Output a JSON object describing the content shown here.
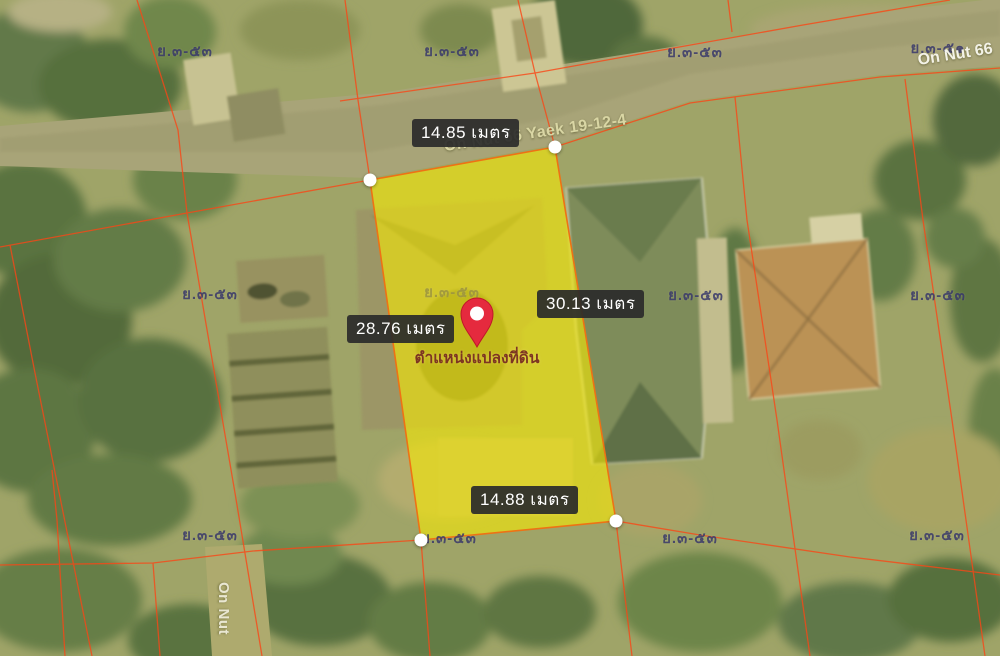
{
  "map": {
    "measurements": {
      "top": "14.85 เมตร",
      "left": "28.76 เมตร",
      "right": "30.13 เมตร",
      "bottom": "14.88 เมตร"
    },
    "pin": {
      "caption": "ตำแหน่งแปลงที่ดิน",
      "color": "#e52a3e"
    },
    "roads": {
      "soi": "On Nut 66 Yaek 19-12-4",
      "main": "On Nut 66",
      "side": "On Nut"
    },
    "zoning_labels": [
      {
        "text": "ย.๓-๕๓"
      },
      {
        "text": "ย.๓-๕๓"
      },
      {
        "text": "ย.๓-๕๓"
      },
      {
        "text": "ย.๓-๕๑"
      },
      {
        "text": "ย.๓-๕๓"
      },
      {
        "text": "ย.๓-๕๓"
      },
      {
        "text": "ย.๓-๕๓"
      },
      {
        "text": "ย.๓-๕๓"
      },
      {
        "text": "ย.๓-๕๓"
      },
      {
        "text": "ย.๓-๕๓"
      },
      {
        "text": "ย.๓-๕๓"
      },
      {
        "text": "ย.๓-๕๓"
      }
    ],
    "colors": {
      "plot_fill": "#f8ec00",
      "cadastral_line": "#fa4616",
      "measure_chip_bg": "#2a2a2a",
      "measure_chip_text": "#ffffff",
      "zoning_text": "#39396b",
      "pin_caption_text": "#7d3522"
    }
  }
}
